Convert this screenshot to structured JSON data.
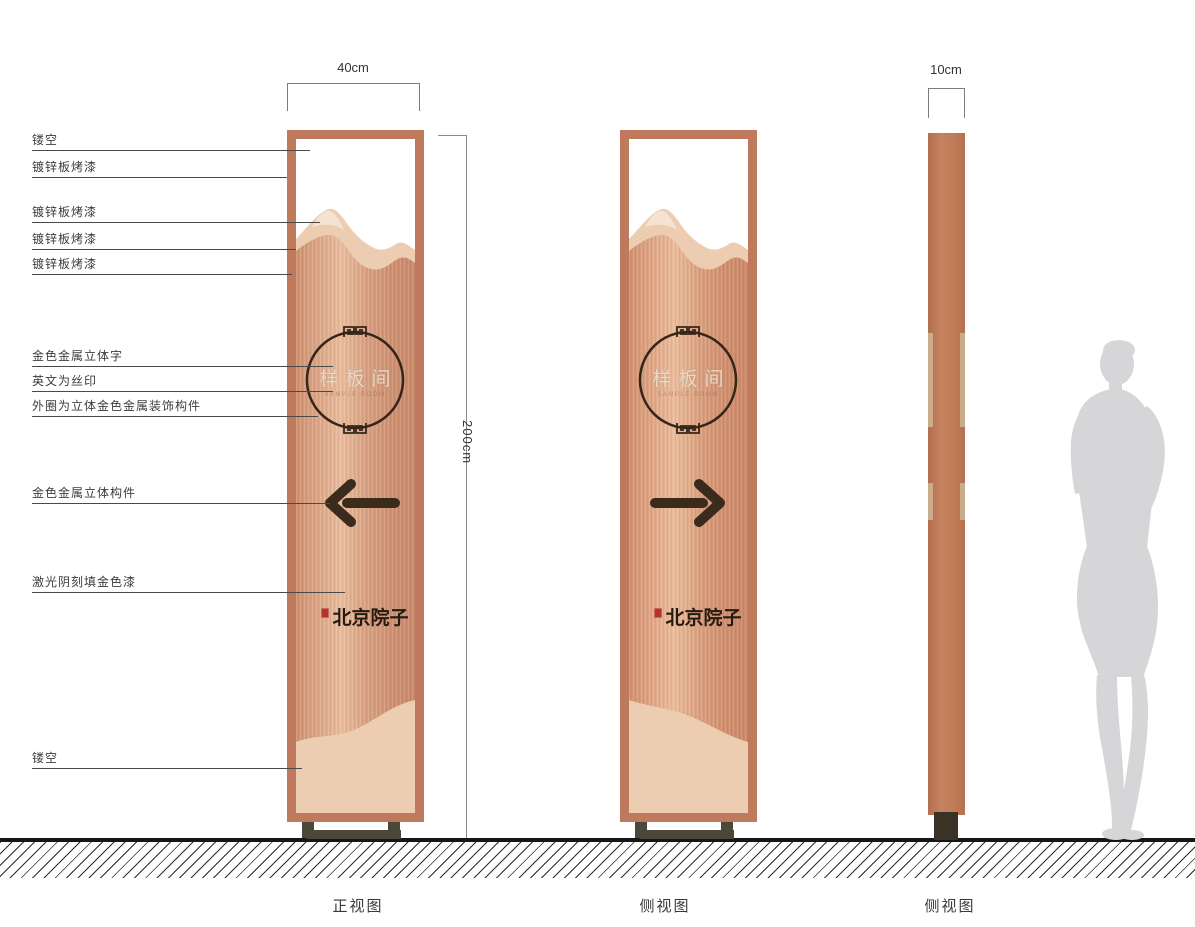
{
  "drawing_title": "signage-elevation-spec",
  "dimensions": {
    "front_width": "40cm",
    "height": "200cm",
    "side_depth": "10cm"
  },
  "captions": {
    "front": "正视图",
    "side1": "侧视图",
    "side2": "侧视图"
  },
  "sign_content": {
    "circle_text": "样板间",
    "english_subtext": "SAMPLE ROOM",
    "logo": "北京院子"
  },
  "annotations": [
    {
      "label": "镂空",
      "top": 133,
      "tip": 310
    },
    {
      "label": "镀锌板烤漆",
      "top": 160,
      "tip": 287
    },
    {
      "label": "镀锌板烤漆",
      "top": 205,
      "tip": 320
    },
    {
      "label": "镀锌板烤漆",
      "top": 232,
      "tip": 296
    },
    {
      "label": "镀锌板烤漆",
      "top": 257,
      "tip": 292
    },
    {
      "label": "金色金属立体字",
      "top": 349,
      "tip": 333
    },
    {
      "label": "英文为丝印",
      "top": 374,
      "tip": 333
    },
    {
      "label": "外圈为立体金色金属装饰构件",
      "top": 399,
      "tip": 318
    },
    {
      "label": "金色金属立体构件",
      "top": 486,
      "tip": 330
    },
    {
      "label": "激光阴刻填金色漆",
      "top": 575,
      "tip": 345
    },
    {
      "label": "镂空",
      "top": 751,
      "tip": 302
    }
  ],
  "colors": {
    "frame_copper": "#bf7a5e",
    "panel_highlight": "#e9bc9c",
    "panel_shadow": "#cf9070",
    "mountain_light": "#edcdb2",
    "ornament_dark": "#35261a",
    "base_olive": "#4b4839",
    "seal_red": "#b43427",
    "silhouette_gray": "#d6d6d8"
  }
}
